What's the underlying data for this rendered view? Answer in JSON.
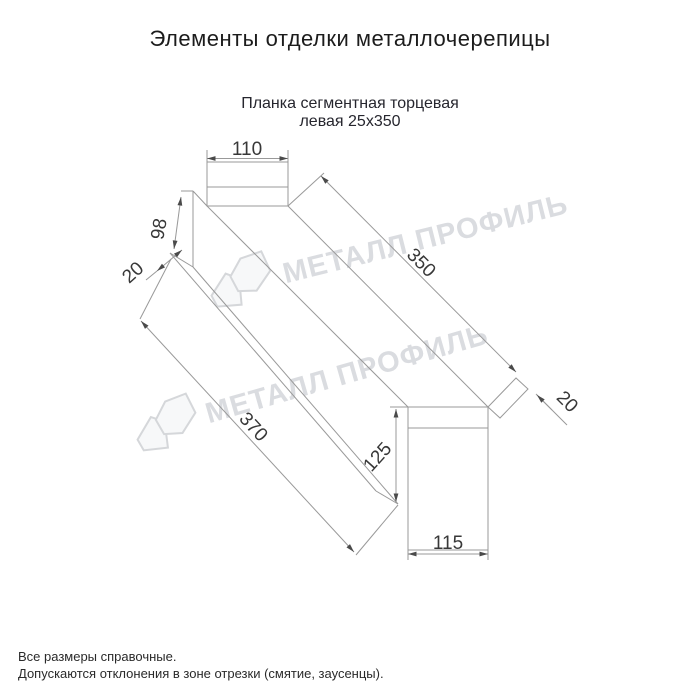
{
  "window": {
    "title": "Элементы отделки металлочерепицы"
  },
  "product": {
    "name_line1": "Планка сегментная торцевая",
    "name_line2": "левая 25х350"
  },
  "drawing": {
    "dims": {
      "top_flange_width": "110",
      "left_face_height": "98",
      "left_fold": "20",
      "top_length": "350",
      "bottom_length": "370",
      "right_fold": "20",
      "end_face_height": "125",
      "end_face_width": "115"
    },
    "colors": {
      "line": "#999999",
      "arrow": "#4a4a4a",
      "dim_text": "#383838"
    }
  },
  "watermark": {
    "text": "МЕТАЛЛ ПРОФИЛЬ",
    "color": "#dadce0"
  },
  "notes": {
    "line1": "Все размеры справочные.",
    "line2": "Допускаются отклонения в зоне отрезки (смятие, заусенцы)."
  }
}
